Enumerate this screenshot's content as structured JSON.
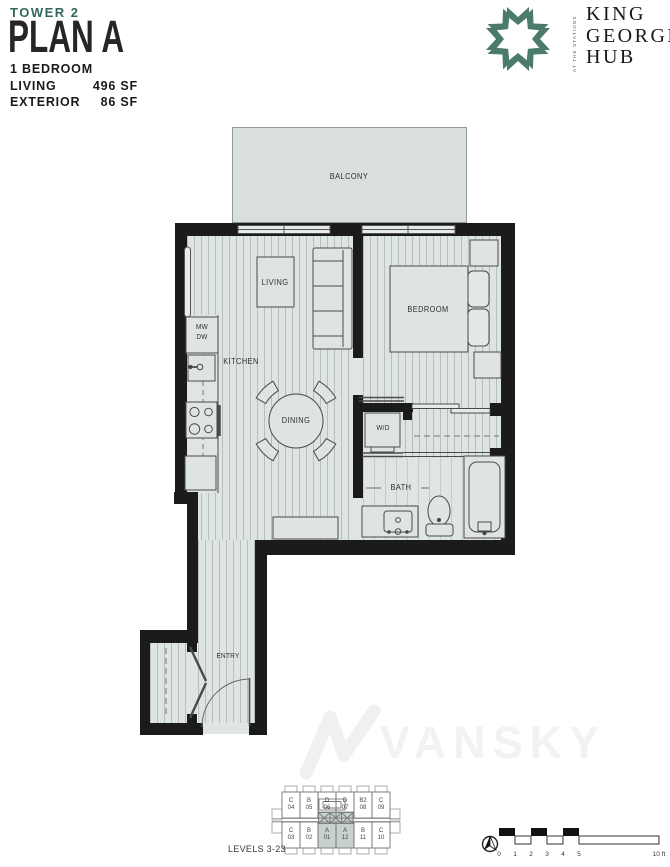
{
  "header": {
    "tower": "TOWER 2",
    "plan": "PLAN A",
    "type": "1 BEDROOM",
    "areas": [
      {
        "label": "LIVING",
        "value": "496 SF"
      },
      {
        "label": "EXTERIOR",
        "value": "86 SF"
      }
    ]
  },
  "brand": {
    "lines": [
      "KING",
      "GEORGE",
      "HUB"
    ],
    "tagline": "AT THE STATIONS"
  },
  "plan_labels": {
    "balcony": "BALCONY",
    "living": "LIVING",
    "bedroom": "BEDROOM",
    "kitchen": "KITCHEN",
    "dining": "DINING",
    "wd": "W/D",
    "bath": "BATH",
    "entry": "ENTRY",
    "mw": "MW",
    "dw": "DW"
  },
  "keyplan": {
    "levels_label": "LEVELS 3-23",
    "top_row": [
      {
        "letter": "C",
        "number": "04"
      },
      {
        "letter": "B",
        "number": "05"
      },
      {
        "letter": "D",
        "number": "06"
      },
      {
        "letter": "D",
        "number": "07"
      },
      {
        "letter": "B2",
        "number": "08"
      },
      {
        "letter": "C",
        "number": "09"
      }
    ],
    "bottom_row": [
      {
        "letter": "C",
        "number": "03"
      },
      {
        "letter": "B",
        "number": "02"
      },
      {
        "letter": "A",
        "number": "01"
      },
      {
        "letter": "A",
        "number": "12"
      },
      {
        "letter": "B",
        "number": "11"
      },
      {
        "letter": "C",
        "number": "10"
      }
    ],
    "highlighted_units": [
      "A 01",
      "A 12"
    ]
  },
  "scale_bar": {
    "ticks": [
      "0",
      "1",
      "2",
      "3",
      "4",
      "5"
    ],
    "end_label": "10 ft"
  },
  "watermark": "VANSKY",
  "colors": {
    "accent_teal": "#30695c",
    "logo_green": "#4a7b6b",
    "wall": "#1b1b1b",
    "floor": "#dee4e1",
    "keyplan_highlight": "#c6d2cb"
  }
}
